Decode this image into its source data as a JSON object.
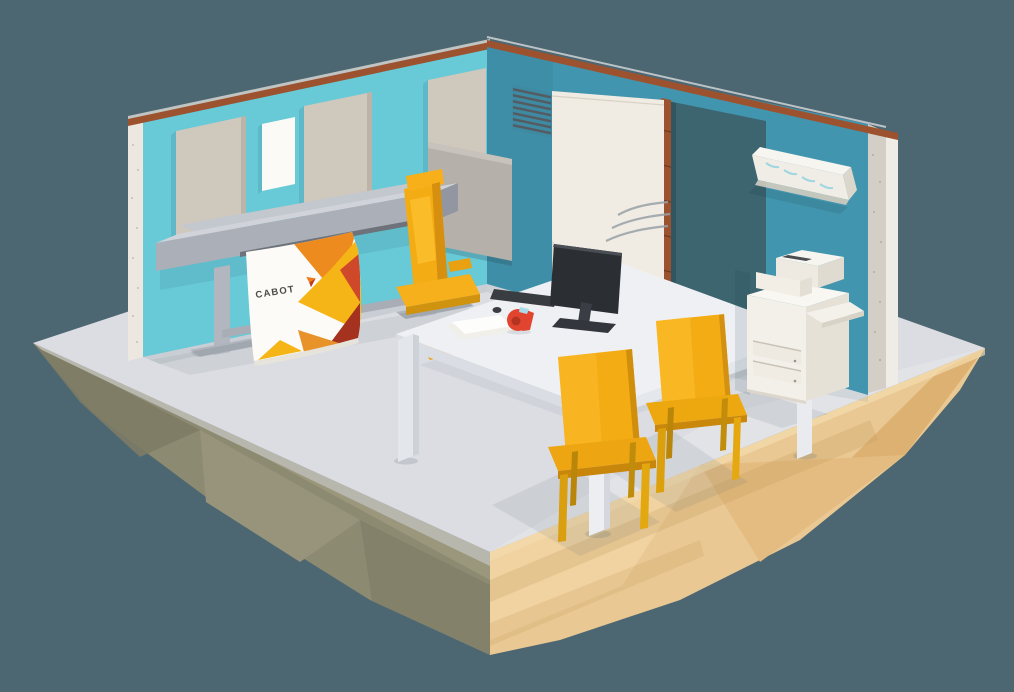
{
  "poster": {
    "brand": "CABOT"
  },
  "colors": {
    "bg": "#4c6771",
    "wall_left": "#68c9d7",
    "wall_right": "#4295ae",
    "floor": "#dcdde2",
    "island_sunlit": "#eac893",
    "island_shadow": "#8d8a72",
    "accent_yellow": "#f3ac14",
    "furniture_white": "#f3f0ea",
    "copper_trim": "#9c522f",
    "plotter_gray": "#b2b6be",
    "poster_orange": "#ee8b1e",
    "poster_yellow": "#f6b517",
    "poster_red": "#d0482a",
    "text_dark": "#4a4a48"
  }
}
